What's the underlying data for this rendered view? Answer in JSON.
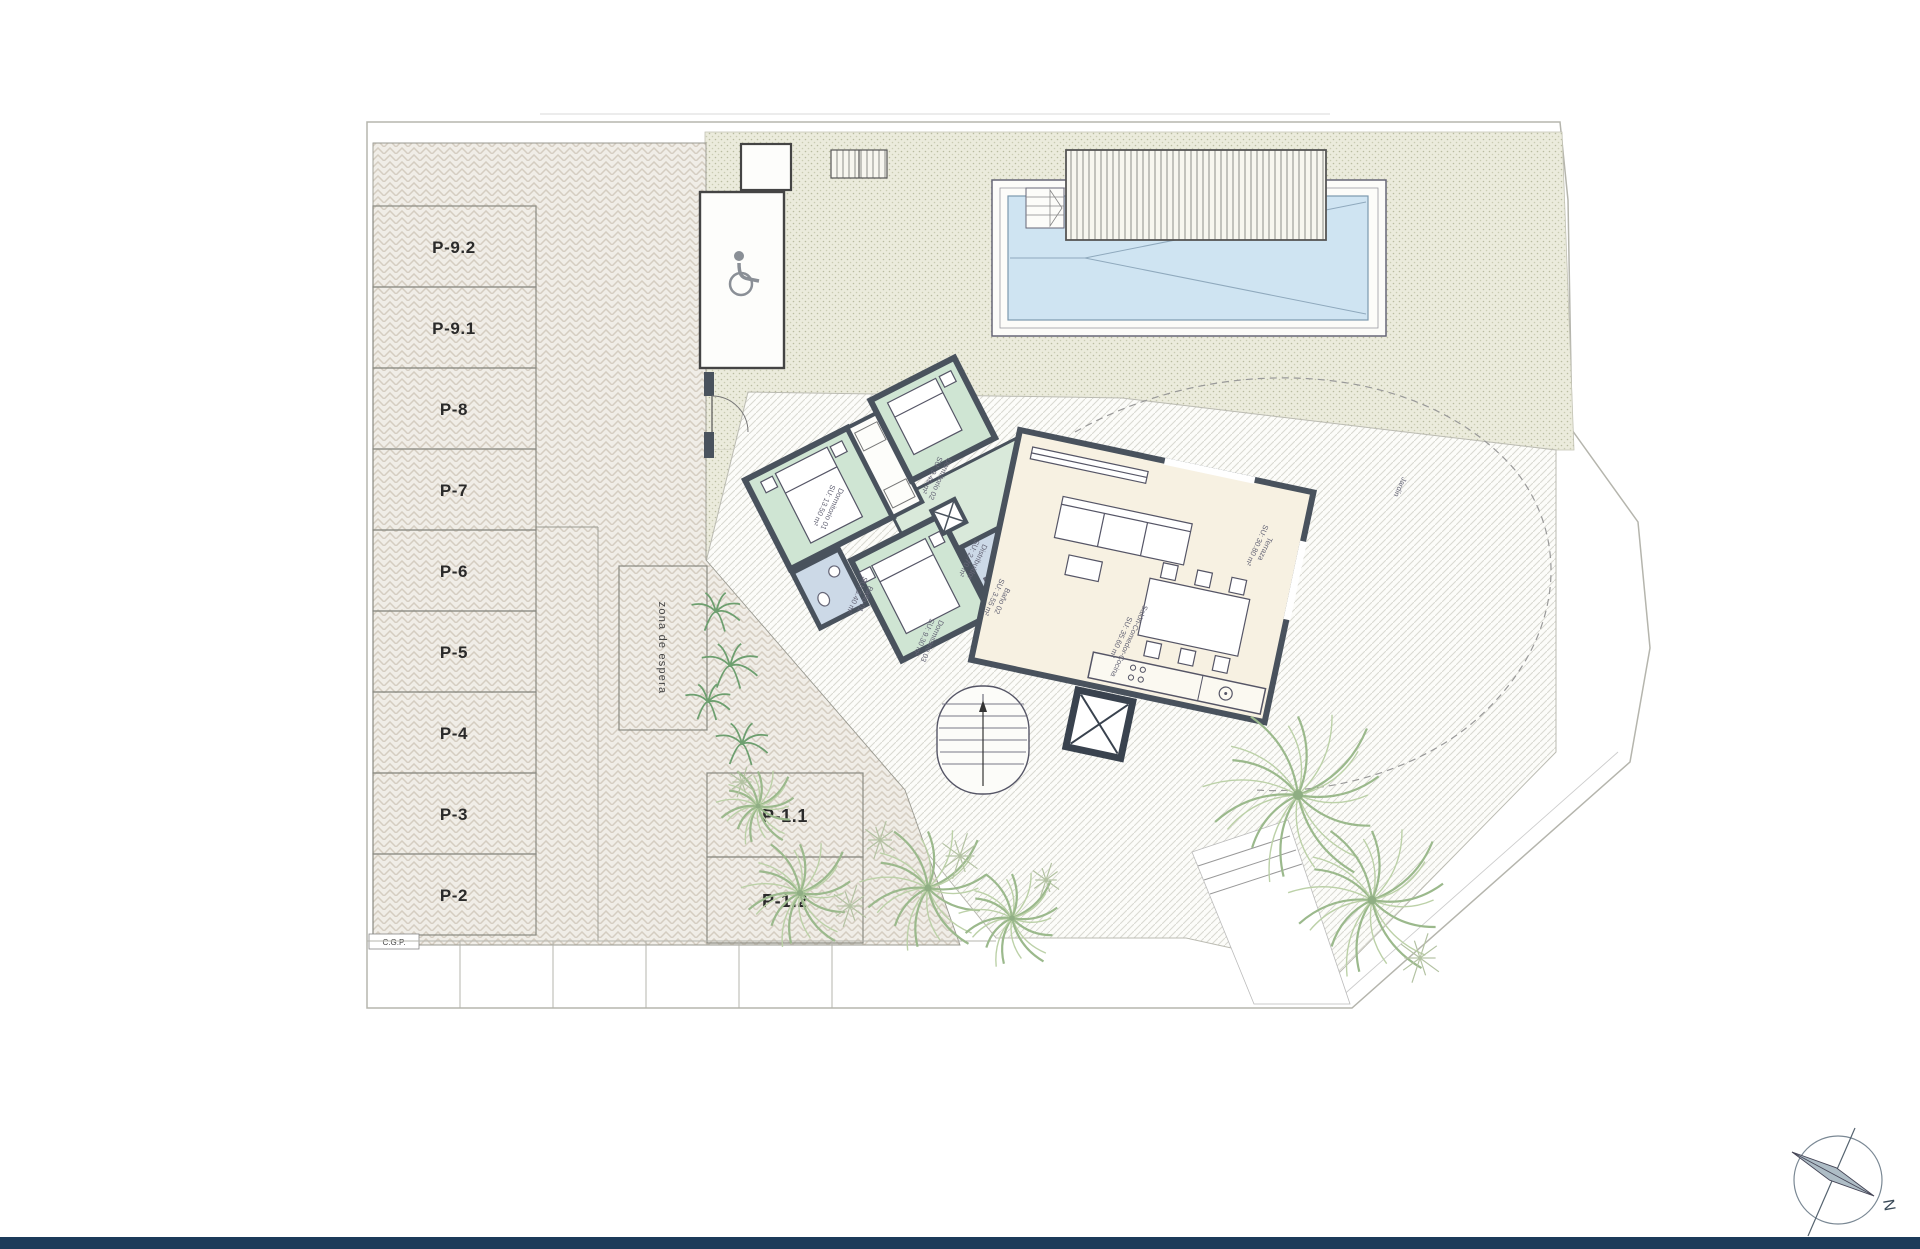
{
  "plan": {
    "north_label": "N"
  },
  "colors": {
    "wall": "#49525d",
    "bedroom_floor": "#cfe5d3",
    "hall_floor": "#d9e9da",
    "bath_floor": "#ccd9e7",
    "living_floor": "#f7f1e2",
    "pool_water": "#cfe4f2",
    "paving": "#f0ede7",
    "garden": "#ebebdc",
    "footer_bar": "#1c3b5a"
  },
  "parking": {
    "stalls": [
      "P-9.2",
      "P-9.1",
      "P-8",
      "P-7",
      "P-6",
      "P-5",
      "P-4",
      "P-3",
      "P-2"
    ],
    "front_stalls": [
      "P-1.1",
      "P-1.2"
    ],
    "waiting_zone_label": "zona de espera",
    "utility_label": "C.G.P."
  },
  "rooms": {
    "d01": {
      "name": "Dormitorio 01",
      "area": "SU: 13.50 m²"
    },
    "d02": {
      "name": "Dormitorio 02",
      "area": "SU: 9.40 m²"
    },
    "d03": {
      "name": "Dormitorio 03",
      "area": "SU: 9.30 m²"
    },
    "bath1": {
      "name": "Baño 01",
      "area": "SU: 3.40 m²"
    },
    "bath2": {
      "name": "Baño 02",
      "area": "SU: 3.55 m²"
    },
    "hall": {
      "name": "Distribuidor",
      "area": "SU: 2.70 m²"
    },
    "living": {
      "name": "Salón-Comedor-Cocina",
      "area": "SU: 35.60 m²"
    },
    "terrace": {
      "name": "Terraza",
      "area": "SU: 30.80 m²"
    },
    "garden": {
      "name": "Jardín",
      "area": ""
    }
  },
  "compass": {
    "north": "N"
  }
}
